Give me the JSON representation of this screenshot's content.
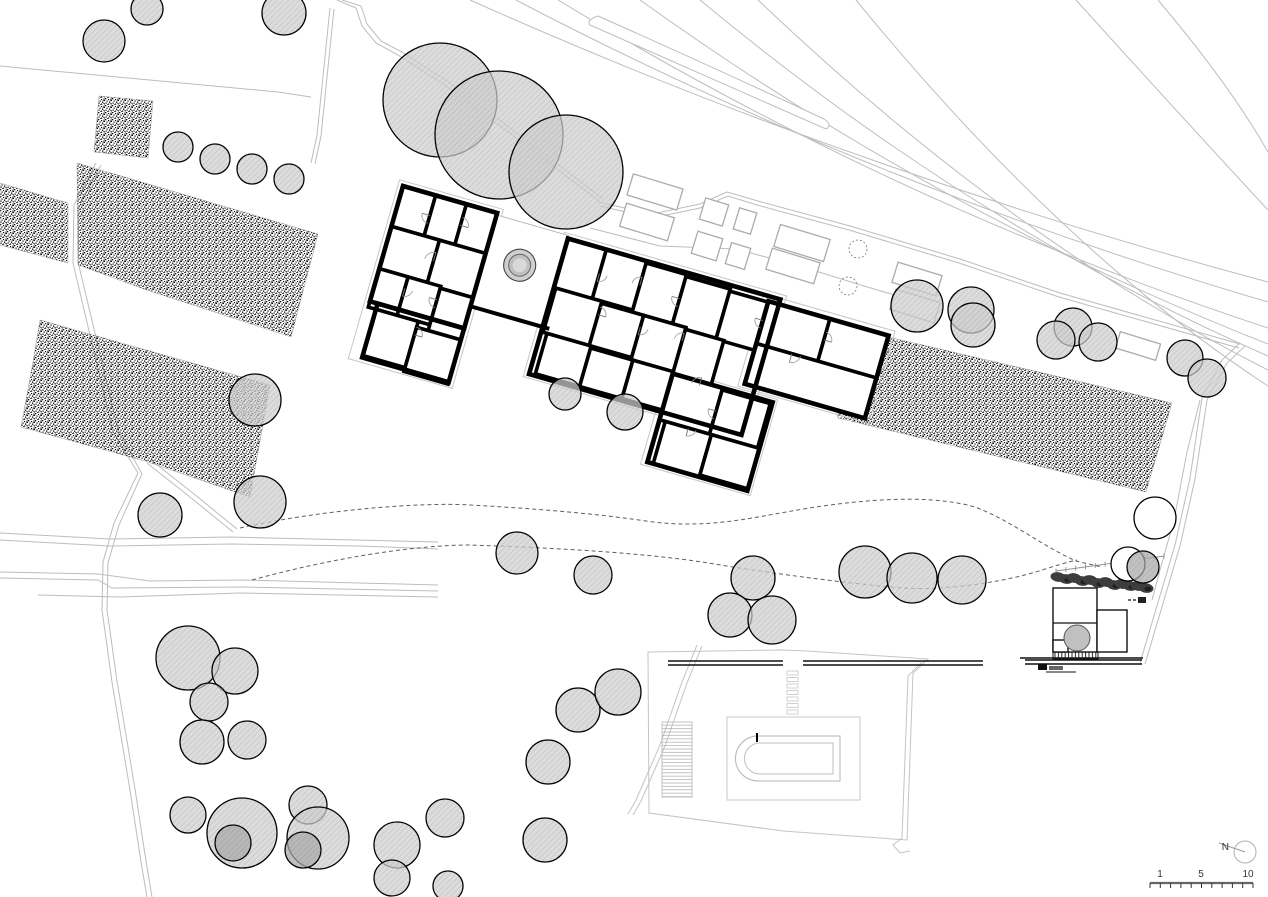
{
  "site": {
    "width": 1268,
    "height": 897,
    "background": "#ffffff",
    "type_label": "architectural site plan"
  },
  "palette": {
    "line_light": "#bdbdbd",
    "line_mid": "#9b9b9b",
    "dashed": "#5f5f5f",
    "wall": "#000000",
    "ink": "#111111",
    "tree_fill": "#cfcfcf",
    "tree_dark": "#a9a9a9",
    "tree_hatch": "#8a8a8a",
    "tree_stroke": "#000000",
    "hedge": "#3d3d3d",
    "hedge_dark": "#1e1e1e",
    "label": "#333333",
    "bed_line": "#ababab",
    "deck_line": "#c9c9c9",
    "pool_line": "#b5b5b5"
  },
  "north": {
    "label": "N",
    "cx": 1245,
    "cy": 852,
    "r": 11,
    "needle": [
      1245,
      852,
      1219,
      843
    ],
    "label_x": 1229,
    "label_y": 850
  },
  "scalebar": {
    "x1": 1150,
    "x2": 1253,
    "y": 883,
    "ticks": 11,
    "tick_len": 5,
    "labels": [
      {
        "text": "1",
        "x": 1160,
        "y": 877
      },
      {
        "text": "5",
        "x": 1201,
        "y": 877
      },
      {
        "text": "10",
        "x": 1248,
        "y": 877
      }
    ]
  },
  "roads": [
    "M0,66 L278,92 L311,97",
    "M337,0 L356,8 L362,26 L376,43 L398,55 L446,86 Q520,140 600,202",
    "M342,0 L361,6 L367,24 L381,41 L402,52 L450,83 Q523,137 603,199",
    "M330,8 L317,135 L311,163",
    "M334,9 L321,136 L315,164",
    "M96,163 L74,205 L73,263 L90,335 L113,432 L138,473 L114,523 L103,562 L102,610 L112,682 L130,790 L141,862 L147,897",
    "M101,165 L79,207 L78,262 L95,333 L118,430 L142,474 L119,525 L108,563 L107,610 L117,681 L135,789 L146,861 L152,897",
    "M147,463 L190,497 L233,532",
    "M151,460 L194,494 L237,529",
    "M0,540 L110,546 L230,544 L360,546 L438,549",
    "M0,533 L110,539 L230,537 L438,542",
    "M0,578 L98,580 L112,588 L243,587 L438,591",
    "M0,572 L98,574 L150,581 L243,580 L438,585",
    "M38,595 L120,597 L240,593 L438,597",
    "M470,0 Q850,170 1268,282",
    "M516,0 Q870,185 1268,302",
    "M558,0 Q895,205 1268,328",
    "M640,0 Q940,215 1268,344",
    "M700,0 Q975,228 1268,356",
    "M758,0 Q1010,240 1268,370",
    "M856,0 Q1060,250 1268,386",
    "M1076,0 Q1180,115 1268,210",
    "M1158,0 Q1230,85 1268,152",
    "M598,202 L652,214 L700,204 L727,192 L758,201 L850,226 L960,259 L1060,293 L1240,344",
    "M600,206 L652,218 L700,208 L728,196 L757,205 L849,230 L959,263 L1059,297 L1239,348",
    "M590,228 L660,246 L736,249 L806,268 L864,286 L918,302",
    "M1240,343 L1222,360 L1202,398 L1190,478 L1175,545 L1140,663",
    "M1245,346 L1227,363 L1207,400 L1195,479 L1180,546 L1145,664",
    "M1200,400 L1187,452 L1174,520 L1160,570 L1152,600"
  ],
  "teardrop": "M598,16 Q715,68 824,119 Q833,125 826,129 Q714,80 590,25 Q586,20 598,16 Z",
  "stipple_areas": [
    "99,96 153,101 148,158 94,152",
    "0,183 68,203 68,263 0,245",
    "77,163 318,234 291,337 144,289 78,265",
    "40,320 270,385 250,497 145,461 21,427 33,362",
    "815,320 1172,403 1146,492 838,418"
  ],
  "bed_rotation": 17,
  "beds": [
    [
      655,
      192,
      52,
      22
    ],
    [
      714,
      212,
      24,
      22
    ],
    [
      745,
      221,
      18,
      22
    ],
    [
      802,
      243,
      52,
      23
    ],
    [
      647,
      222,
      50,
      24
    ],
    [
      707,
      246,
      26,
      23
    ],
    [
      738,
      256,
      20,
      22
    ],
    [
      793,
      266,
      50,
      22
    ],
    [
      917,
      279,
      46,
      21
    ],
    [
      915,
      306,
      46,
      21
    ],
    [
      1138,
      346,
      42,
      17
    ]
  ],
  "bed_circles": [
    [
      858,
      249,
      9
    ],
    [
      848,
      286,
      9
    ]
  ],
  "dashed_paths": [
    "M240,528 C320,510 420,502 470,505 C560,510 612,516 646,521 C715,531 762,514 830,505 C890,497 940,497 975,507 C1012,521 1042,546 1076,561 L1102,567",
    "M252,580 C340,556 420,545 470,545 C560,548 642,553 702,562 C762,572 842,583 902,588 C952,591 1012,580 1042,570 C1058,565 1068,562 1077,560"
  ],
  "trees": [
    [
      104,
      41,
      21,
      "s"
    ],
    [
      147,
      9,
      16,
      "s"
    ],
    [
      284,
      13,
      22,
      "s"
    ],
    [
      178,
      147,
      15,
      "s"
    ],
    [
      215,
      159,
      15,
      "s"
    ],
    [
      252,
      169,
      15,
      "s"
    ],
    [
      289,
      179,
      15,
      "s"
    ],
    [
      440,
      100,
      57,
      "s"
    ],
    [
      499,
      135,
      64,
      "s"
    ],
    [
      566,
      172,
      57,
      "s"
    ],
    [
      255,
      400,
      26,
      "s"
    ],
    [
      160,
      515,
      22,
      "s"
    ],
    [
      260,
      502,
      26,
      "s"
    ],
    [
      565,
      394,
      16,
      "s"
    ],
    [
      625,
      412,
      18,
      "s"
    ],
    [
      517,
      553,
      21,
      "s"
    ],
    [
      593,
      575,
      19,
      "s"
    ],
    [
      753,
      578,
      22,
      "s"
    ],
    [
      730,
      615,
      22,
      "s"
    ],
    [
      772,
      620,
      24,
      "s"
    ],
    [
      865,
      572,
      26,
      "s"
    ],
    [
      912,
      578,
      25,
      "s"
    ],
    [
      962,
      580,
      24,
      "s"
    ],
    [
      917,
      306,
      26,
      "s"
    ],
    [
      971,
      310,
      23,
      "s"
    ],
    [
      973,
      325,
      22,
      "s"
    ],
    [
      1073,
      327,
      19,
      "s"
    ],
    [
      1056,
      340,
      19,
      "s"
    ],
    [
      1098,
      342,
      19,
      "s"
    ],
    [
      1185,
      358,
      18,
      "s"
    ],
    [
      1207,
      378,
      19,
      "s"
    ],
    [
      188,
      658,
      32,
      "s"
    ],
    [
      235,
      671,
      23,
      "s"
    ],
    [
      209,
      702,
      19,
      "s"
    ],
    [
      202,
      742,
      22,
      "s"
    ],
    [
      247,
      740,
      19,
      "s"
    ],
    [
      188,
      815,
      18,
      "s"
    ],
    [
      242,
      833,
      35,
      "s"
    ],
    [
      233,
      843,
      18,
      "d"
    ],
    [
      308,
      805,
      19,
      "s"
    ],
    [
      318,
      838,
      31,
      "s"
    ],
    [
      303,
      850,
      18,
      "d"
    ],
    [
      397,
      845,
      23,
      "s"
    ],
    [
      392,
      878,
      18,
      "s"
    ],
    [
      445,
      818,
      19,
      "s"
    ],
    [
      448,
      886,
      15,
      "s"
    ],
    [
      548,
      762,
      22,
      "s"
    ],
    [
      545,
      840,
      22,
      "s"
    ],
    [
      578,
      710,
      22,
      "s"
    ],
    [
      618,
      692,
      23,
      "s"
    ],
    [
      1155,
      518,
      21,
      "w"
    ],
    [
      1128,
      564,
      17,
      "w"
    ],
    [
      1143,
      567,
      16,
      "d"
    ],
    [
      1077,
      638,
      13,
      "p"
    ]
  ],
  "building": {
    "x": 403,
    "y": 186,
    "rotation": 16,
    "offsets": [
      [
        -5,
        -5,
        108,
        186
      ],
      [
        168,
        0,
        231,
        150
      ],
      [
        377,
        4,
        136,
        96
      ],
      [
        305,
        102,
        114,
        100
      ]
    ],
    "rooms": [
      [
        0,
        0,
        34,
        42
      ],
      [
        34,
        0,
        32,
        42
      ],
      [
        66,
        0,
        32,
        44
      ],
      [
        0,
        42,
        50,
        44
      ],
      [
        50,
        42,
        48,
        46
      ],
      [
        0,
        86,
        30,
        40
      ],
      [
        30,
        86,
        34,
        40
      ],
      [
        64,
        88,
        34,
        44
      ],
      [
        8,
        126,
        44,
        48
      ],
      [
        52,
        132,
        46,
        46
      ],
      [
        173,
        5,
        40,
        51
      ],
      [
        213,
        5,
        42,
        51
      ],
      [
        255,
        7,
        42,
        51
      ],
      [
        297,
        9,
        46,
        51
      ],
      [
        343,
        11,
        40,
        50
      ],
      [
        175,
        56,
        48,
        46
      ],
      [
        223,
        58,
        44,
        44
      ],
      [
        267,
        58,
        44,
        46
      ],
      [
        311,
        60,
        40,
        46
      ],
      [
        179,
        102,
        46,
        42
      ],
      [
        225,
        104,
        44,
        40
      ],
      [
        269,
        104,
        42,
        40
      ],
      [
        383,
        10,
        64,
        44
      ],
      [
        447,
        10,
        61,
        44
      ],
      [
        383,
        54,
        125,
        42
      ],
      [
        311,
        106,
        52,
        48
      ],
      [
        363,
        108,
        50,
        46
      ],
      [
        317,
        154,
        48,
        44
      ],
      [
        365,
        154,
        50,
        42
      ]
    ],
    "shells": [
      [
        0,
        0,
        98,
        120
      ],
      [
        8,
        120,
        90,
        56
      ],
      [
        173,
        5,
        221,
        141
      ],
      [
        383,
        10,
        125,
        86
      ],
      [
        311,
        106,
        104,
        92
      ]
    ],
    "walls": [
      [
        98,
        97,
        180,
        97
      ]
    ],
    "courtyard": [
      98,
      2,
      75,
      94
    ],
    "doors": [
      [
        34,
        21,
        8,
        90
      ],
      [
        66,
        22,
        8,
        270
      ],
      [
        50,
        64,
        9,
        180
      ],
      [
        30,
        98,
        8,
        0
      ],
      [
        64,
        100,
        8,
        90
      ],
      [
        52,
        140,
        8,
        270
      ],
      [
        213,
        30,
        8,
        0
      ],
      [
        255,
        30,
        8,
        180
      ],
      [
        297,
        32,
        8,
        90
      ],
      [
        223,
        70,
        8,
        270
      ],
      [
        267,
        70,
        8,
        0
      ],
      [
        311,
        72,
        8,
        180
      ],
      [
        383,
        30,
        8,
        90
      ],
      [
        447,
        32,
        8,
        270
      ],
      [
        420,
        54,
        9,
        0
      ],
      [
        340,
        110,
        8,
        180
      ],
      [
        363,
        130,
        8,
        90
      ],
      [
        341,
        154,
        8,
        0
      ]
    ],
    "fountain": {
      "x": 134,
      "y": 44,
      "radii": [
        16,
        11,
        7
      ]
    }
  },
  "pool": {
    "boundary": "M648,652 L783,650 L807,651 L928,659 L913,673 L907,840 L783,831 L649,813 Z",
    "boundary2": "M922,662 L908,676 L902,838 L893,845 L900,853 L910,851",
    "diag": [
      "M697,645 L682,682 L660,745 L636,800 L628,814",
      "M702,646 L687,683 L665,746 L641,801 L633,815"
    ],
    "deck": [
      727,
      717,
      133,
      83
    ],
    "outer": "M758,736 L840,736 L840,781 L758,781 A22.5 22.5 0 0 1 758,736 Z",
    "inner": "M760,743 L833,743 L833,774 L760,774 A15.5 15.5 0 0 1 760,743 Z",
    "tick": [
      756,
      733,
      2,
      9
    ],
    "ramp": [
      662,
      722,
      30,
      75
    ],
    "steps": {
      "x": 787,
      "y": 671,
      "w": 11,
      "h": 4,
      "gap": 6.5,
      "count": 7
    },
    "walls": [
      [
        668,
        661,
        783,
        661
      ],
      [
        668,
        665,
        783,
        665
      ],
      [
        803,
        661,
        983,
        661
      ],
      [
        803,
        665,
        983,
        665
      ],
      [
        1025,
        660,
        1142,
        660
      ],
      [
        1025,
        664,
        1142,
        664
      ]
    ]
  },
  "annex": {
    "base": [
      1020,
      658,
      1143,
      658
    ],
    "stairs": [
      1053,
      649,
      45,
      10
    ],
    "rooms": [
      [
        1053,
        588,
        44,
        64
      ],
      [
        1097,
        610,
        30,
        42
      ],
      [
        1053,
        640,
        15,
        12
      ]
    ],
    "divider": [
      1053,
      623,
      1097,
      623
    ],
    "dash_line": [
      1128,
      600,
      1136,
      600
    ],
    "dash_box": [
      1138,
      597,
      8,
      6
    ],
    "marks": [
      [
        1038,
        664,
        9,
        6,
        "#111111"
      ],
      [
        1049,
        666,
        14,
        4,
        "#666666"
      ]
    ],
    "mark_line": [
      1046,
      672,
      1076,
      672
    ],
    "hedge": [
      [
        1058,
        577
      ],
      [
        1066,
        579
      ],
      [
        1074,
        578
      ],
      [
        1082,
        581
      ],
      [
        1090,
        580
      ],
      [
        1098,
        583
      ],
      [
        1106,
        582
      ],
      [
        1114,
        585
      ],
      [
        1122,
        584
      ],
      [
        1130,
        586
      ],
      [
        1138,
        586
      ],
      [
        1146,
        588
      ]
    ],
    "fence": {
      "x1": 1056,
      "y1": 571,
      "x2": 1164,
      "y2": 556,
      "ticks": 11
    }
  }
}
